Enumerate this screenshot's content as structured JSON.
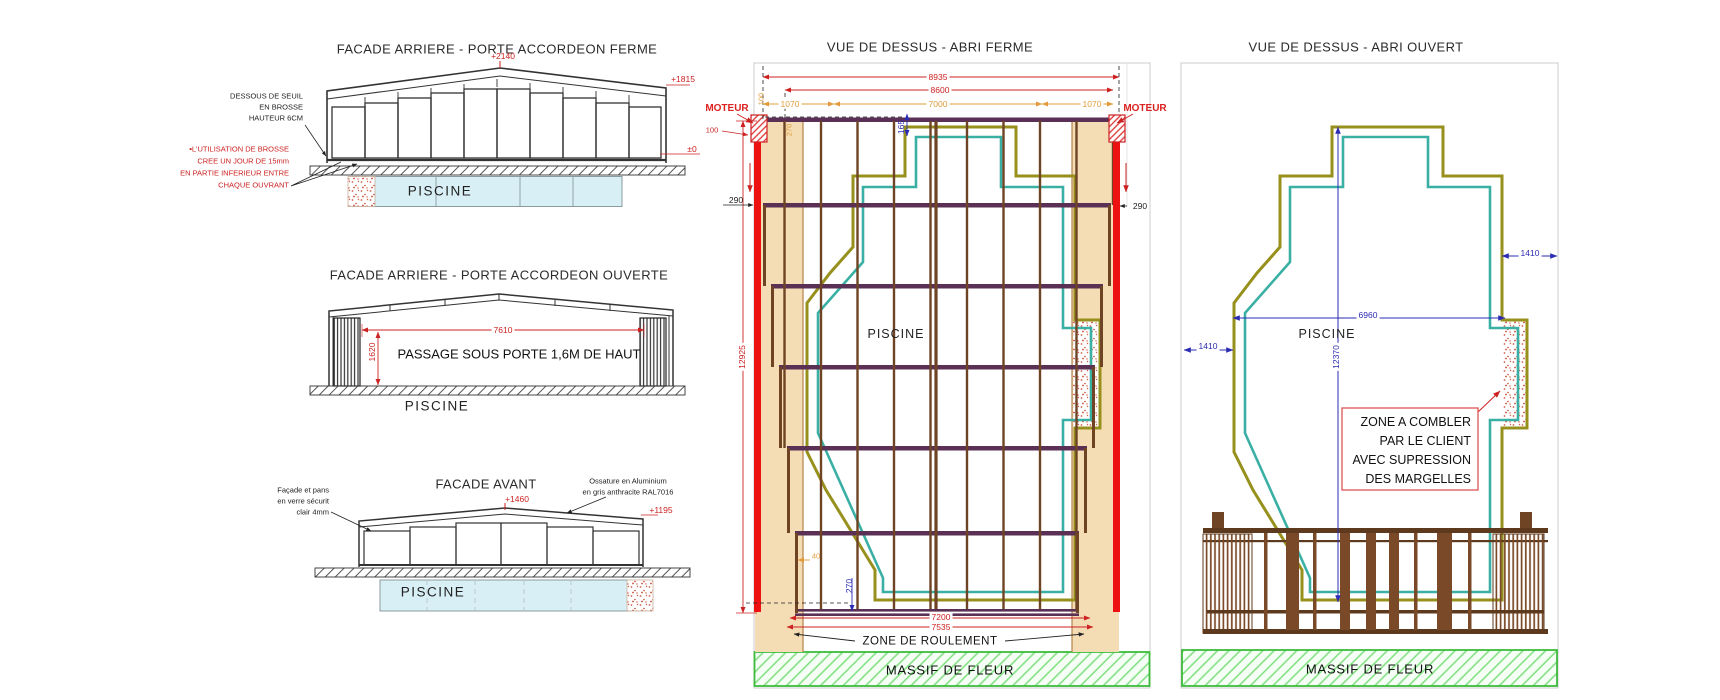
{
  "colors": {
    "dim_red": "#cc2222",
    "dim_orange": "#e09c3c",
    "dim_blue": "#2b2bb4",
    "rail_red": "#ee1111",
    "pool_outline_olive": "#97901d",
    "pool_outline_teal": "#3ab0a4",
    "deck_tan": "#f4dcb4",
    "frame_brown": "#6e4425",
    "rail_purple": "#5a3154",
    "massif_green": "#3dbb3d",
    "pool_blue": "#d8eff5"
  },
  "views": {
    "facade_fermee": {
      "title": "FACADE ARRIERE - PORTE ACCORDEON FERME",
      "piscine": "PISCINE",
      "dim_peak": "+2140",
      "dim_right": "+1815",
      "dim_zero": "±0",
      "note_seuil": [
        "DESSOUS DE SEUIL",
        "EN BROSSE",
        "HAUTEUR 6CM"
      ],
      "note_brosse": [
        "▪L'UTILISATION DE BROSSE",
        "CREE UN JOUR DE 15mm",
        "EN PARTIE INFERIEUR ENTRE",
        "CHAQUE OUVRANT"
      ]
    },
    "facade_ouverte": {
      "title": "FACADE ARRIERE - PORTE ACCORDEON OUVERTE",
      "piscine": "PISCINE",
      "passage": "PASSAGE SOUS PORTE 1,6M DE HAUT",
      "dim_width": "7610",
      "dim_height": "1620"
    },
    "facade_avant": {
      "title": "FACADE AVANT",
      "piscine": "PISCINE",
      "dim_peak": "+1460",
      "dim_right": "+1195",
      "note_verre": [
        "Façade et pans",
        "en verre sécurit",
        "clair 4mm"
      ],
      "note_ossature": [
        "Ossature en Aluminium",
        "en gris anthracite RAL7016"
      ]
    },
    "dessus_ferme": {
      "title": "VUE DE DESSUS - ABRI FERME",
      "piscine": "PISCINE",
      "moteur_left": "MOTEUR",
      "moteur_right": "MOTEUR",
      "dim_total": "8935",
      "dim_inner": "8600",
      "dim_left_1070": "1070",
      "dim_center_7000": "7000",
      "dim_right_1070": "1070",
      "dim_100_orange": "100",
      "dim_100_red": "100",
      "dim_270_orange": "270",
      "dim_165": "165",
      "dim_290_left": "290",
      "dim_290_right": "290",
      "dim_length": "12925",
      "dim_40": "40",
      "dim_270_blue": "270",
      "dim_7200": "7200",
      "dim_7535": "7535",
      "zone_roulement": "ZONE DE ROULEMENT",
      "massif": "MASSIF DE FLEUR"
    },
    "dessus_ouvert": {
      "title": "VUE DE DESSUS - ABRI OUVERT",
      "piscine": "PISCINE",
      "dim_6960": "6960",
      "dim_12370": "12370",
      "dim_1410_left": "1410",
      "dim_1410_right": "1410",
      "zone_combler": [
        "ZONE A COMBLER",
        "PAR LE CLIENT",
        "AVEC SUPRESSION",
        "DES MARGELLES"
      ],
      "massif": "MASSIF DE FLEUR"
    }
  }
}
